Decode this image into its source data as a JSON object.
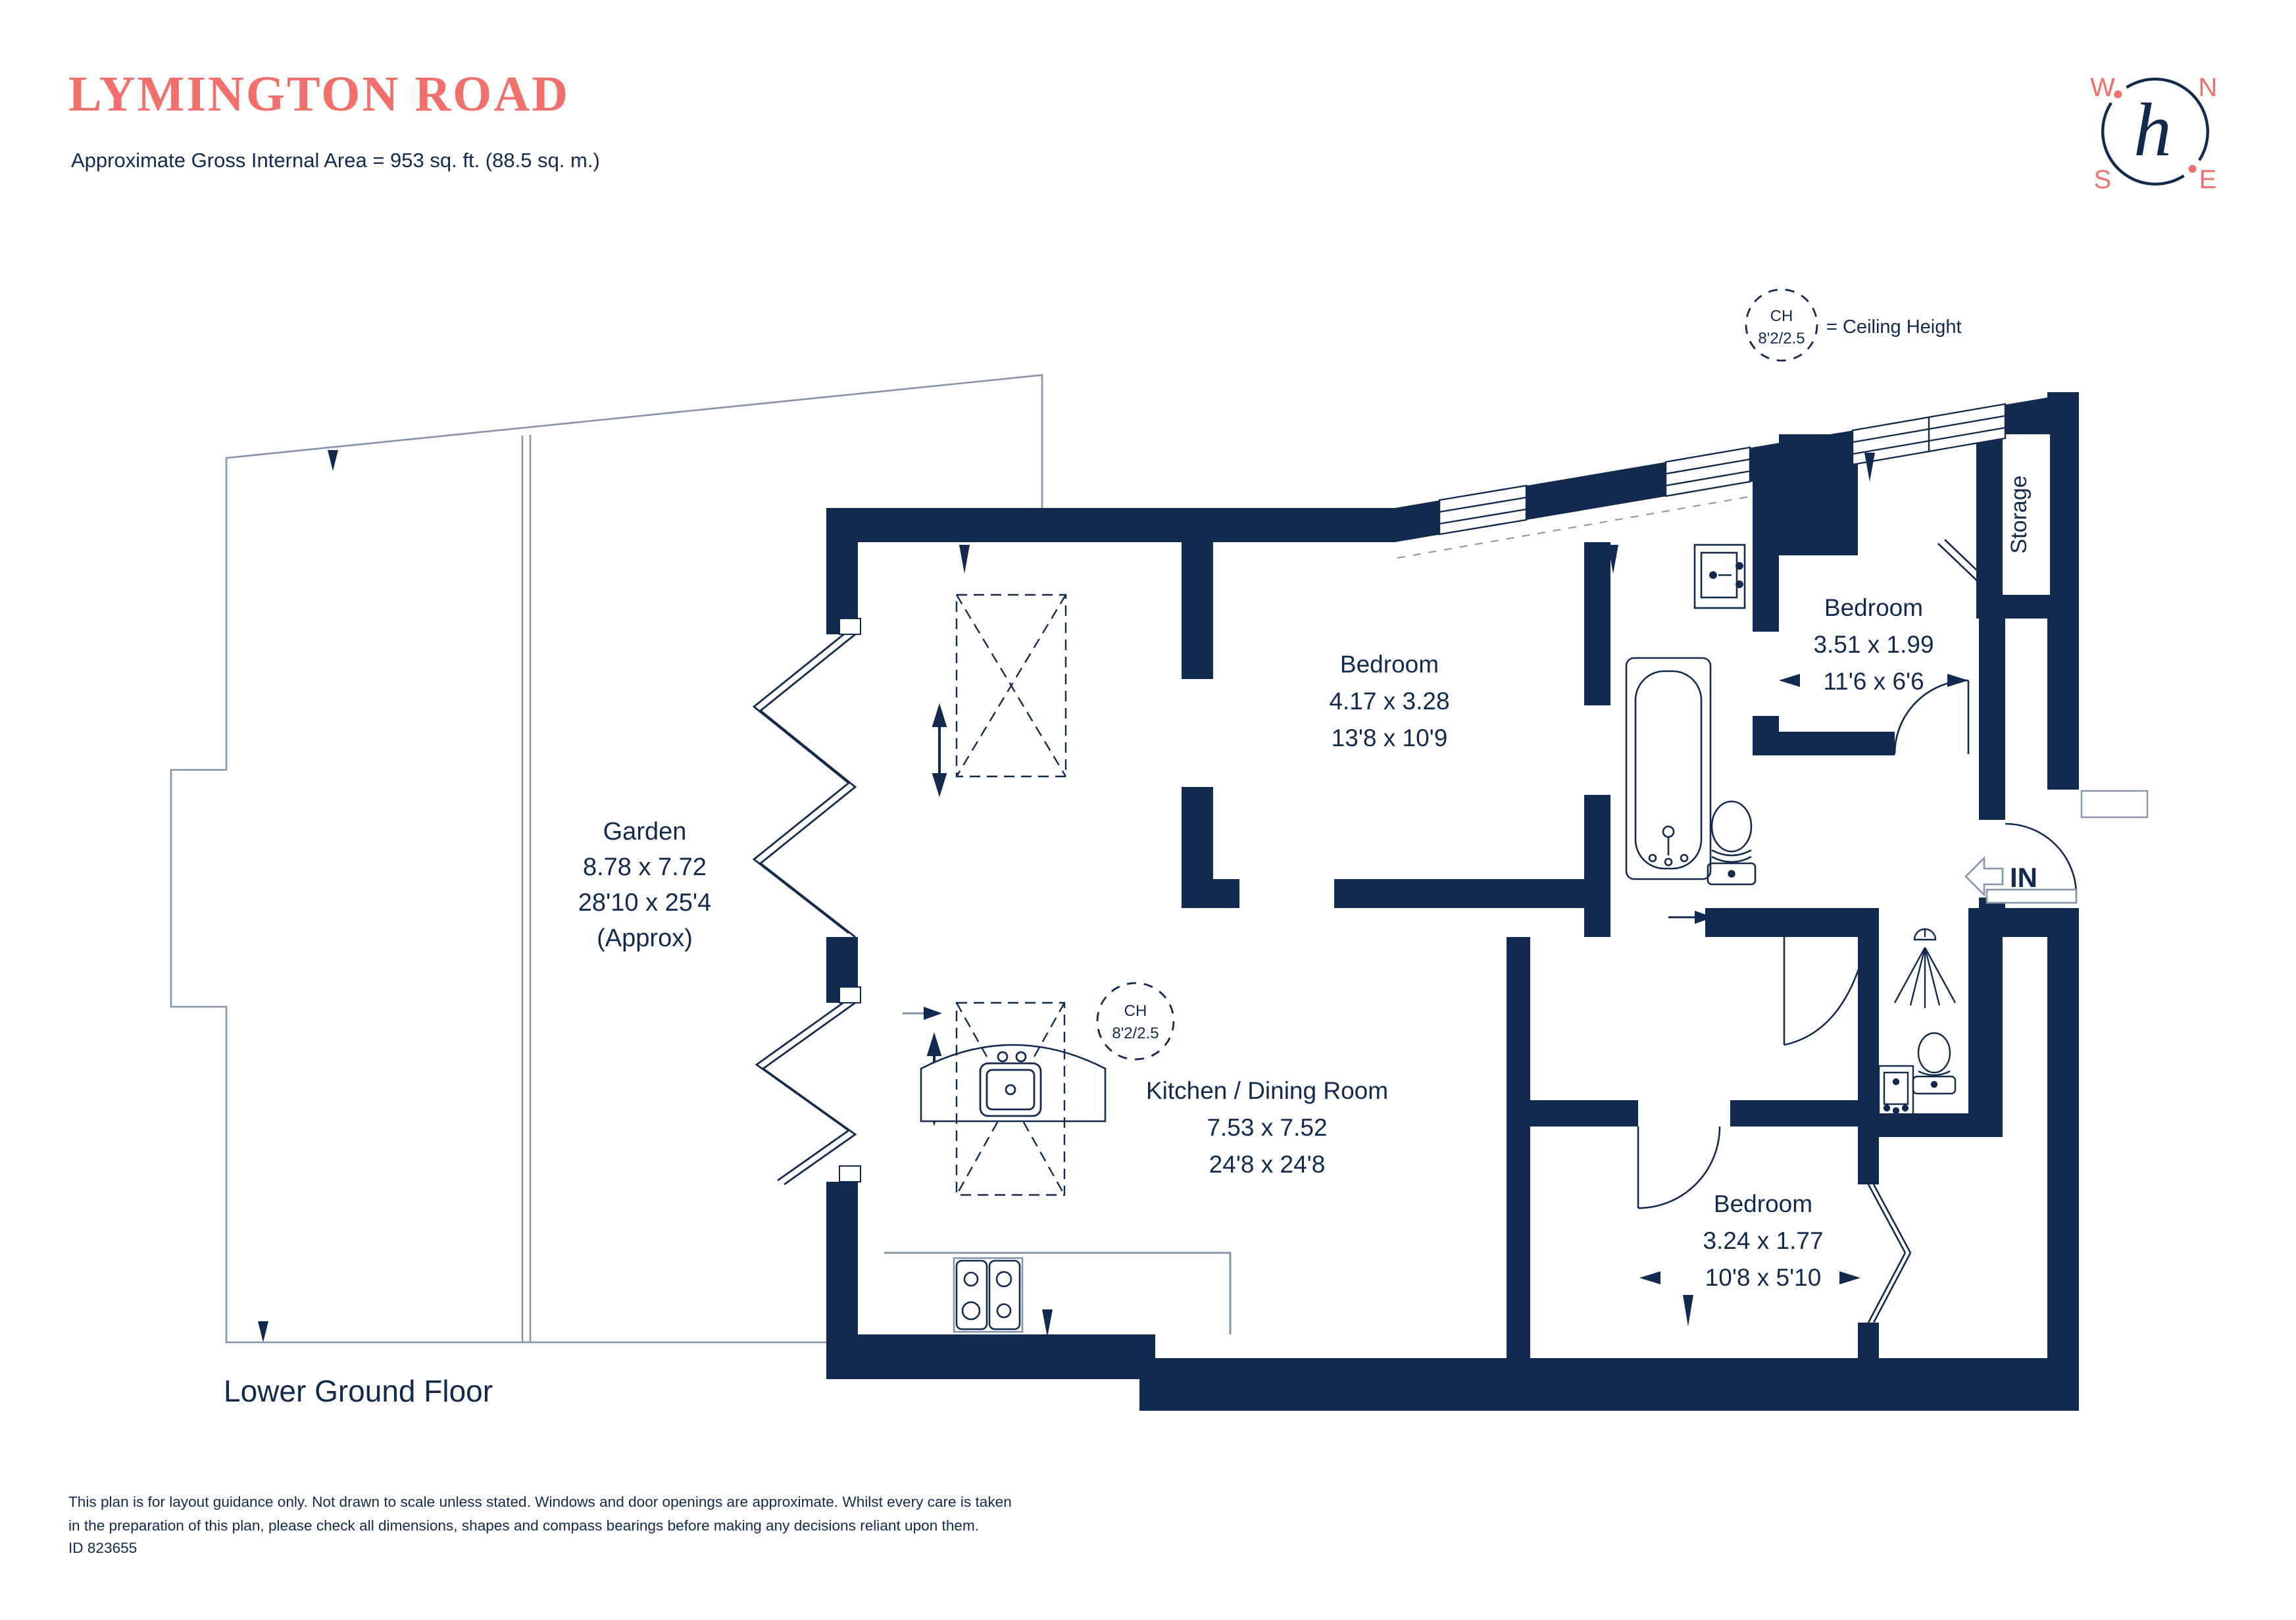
{
  "page": {
    "title": "LYMINGTON ROAD",
    "subtitle": "Approximate Gross Internal Area = 953 sq. ft. (88.5 sq. m.)",
    "floor_label": "Lower Ground Floor"
  },
  "colors": {
    "navy": "#122A4D",
    "coral": "#F2706B",
    "thin_line": "#8494AB"
  },
  "compass": {
    "w": "W",
    "n": "N",
    "s": "S",
    "e": "E",
    "monogram": "h"
  },
  "legend": {
    "ch_abbr": "CH",
    "ch_value": "8'2/2.5",
    "label": "= Ceiling Height"
  },
  "ch_marker": {
    "ch_abbr": "CH",
    "ch_value": "8'2/2.5"
  },
  "entrance": {
    "label": "IN"
  },
  "rooms": {
    "garden": {
      "name": "Garden",
      "metric": "8.78 x 7.72",
      "imperial": "28'10 x 25'4",
      "note": "(Approx)"
    },
    "bedroom_main": {
      "name": "Bedroom",
      "metric": "4.17 x 3.28",
      "imperial": "13'8 x 10'9"
    },
    "bedroom_second": {
      "name": "Bedroom",
      "metric": "3.51 x 1.99",
      "imperial": "11'6 x 6'6"
    },
    "bedroom_third": {
      "name": "Bedroom",
      "metric": "3.24 x 1.77",
      "imperial": "10'8 x 5'10"
    },
    "kitchen": {
      "name": "Kitchen / Dining Room",
      "metric": "7.53 x 7.52",
      "imperial": "24'8 x 24'8"
    },
    "storage": {
      "name": "Storage"
    }
  },
  "footer": {
    "line1": "This plan is for layout guidance only. Not drawn to scale unless stated. Windows and door openings are approximate. Whilst every care is taken",
    "line2": "in the preparation of this plan, please check all dimensions, shapes and compass bearings before making any decisions reliant upon them.",
    "id": "ID 823655"
  }
}
